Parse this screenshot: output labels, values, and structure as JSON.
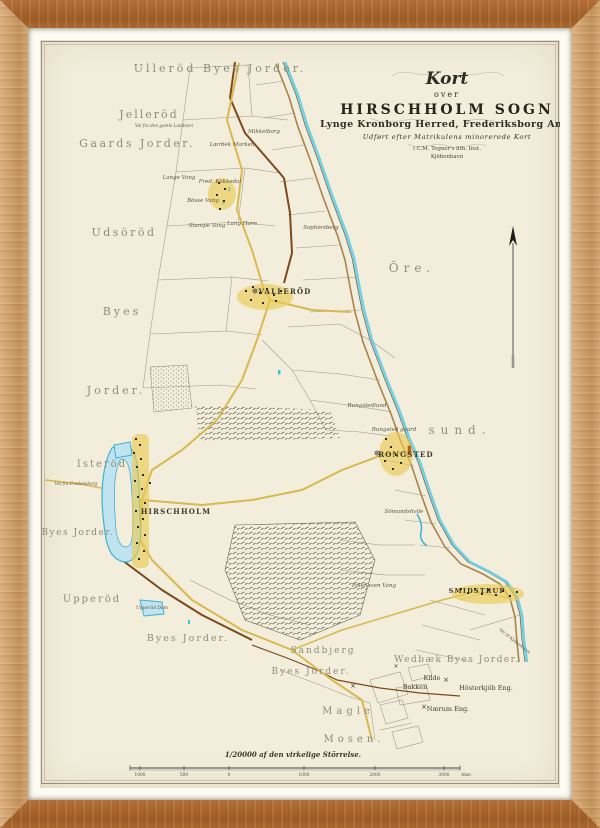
{
  "title_block": {
    "kort": "Kort",
    "over": "over",
    "main": "HIRSCHHOLM SOGN",
    "sub": "Lynge Kronborg Herred, Frederiksborg Amt.",
    "note": "Udført efter Matrikulens minorerede Kort",
    "publisher": "i C.M. Tegner's lith. Inst.",
    "city": "Kjöbenhavn"
  },
  "scale": {
    "caption": "1/20000 af den virkelige Störrelse."
  },
  "palette": {
    "paper": "#f3eedc",
    "mat": "#fdfbf2",
    "frame_wood": "#cb9c66",
    "coast_cyan": "#63cde2",
    "road_yellow": "#d9b84e",
    "road_tan": "#a8834b",
    "boundary_brown": "#7a4a1c",
    "lake_blue": "#3fb0d0",
    "village_yellow": "#e9cb53",
    "building_orange": "#cc6418",
    "label_grey": "#8f8c7c",
    "ink": "#3b372c"
  },
  "map_labels": [
    {
      "t": "Ulleröd Byes Jorder.",
      "x": 180,
      "y": 32,
      "fs": 11,
      "ls": 3,
      "style": "district"
    },
    {
      "t": "Jelleröd",
      "x": 109,
      "y": 78,
      "fs": 11,
      "ls": 2,
      "style": "district"
    },
    {
      "t": "Gaards Jorder.",
      "x": 97,
      "y": 107,
      "fs": 11,
      "ls": 2.5,
      "style": "district"
    },
    {
      "t": "Udsöröd",
      "x": 84,
      "y": 196,
      "fs": 11,
      "ls": 2.5,
      "style": "district"
    },
    {
      "t": "Byes",
      "x": 82,
      "y": 275,
      "fs": 11,
      "ls": 3,
      "style": "district"
    },
    {
      "t": "Jorder.",
      "x": 76,
      "y": 354,
      "fs": 11,
      "ls": 3,
      "style": "district"
    },
    {
      "t": "Isteröd",
      "x": 62,
      "y": 427,
      "fs": 10,
      "ls": 2,
      "style": "district"
    },
    {
      "t": "Byes Jorder.",
      "x": 38,
      "y": 495,
      "fs": 9,
      "ls": 1.5,
      "style": "district"
    },
    {
      "t": "Upperöd",
      "x": 52,
      "y": 562,
      "fs": 10,
      "ls": 2,
      "style": "district"
    },
    {
      "t": "Byes Jorder.",
      "x": 148,
      "y": 601,
      "fs": 9.5,
      "ls": 2,
      "style": "district"
    },
    {
      "t": "Sandbjerg",
      "x": 283,
      "y": 613,
      "fs": 9,
      "ls": 2,
      "style": "district"
    },
    {
      "t": "Byes Jorder.",
      "x": 271,
      "y": 634,
      "fs": 9,
      "ls": 2,
      "style": "district"
    },
    {
      "t": "Magle",
      "x": 308,
      "y": 674,
      "fs": 10,
      "ls": 4,
      "style": "district"
    },
    {
      "t": "Mosen.",
      "x": 314,
      "y": 702,
      "fs": 10,
      "ls": 4,
      "style": "district"
    },
    {
      "t": "Wedbæk Byes Jorder.",
      "x": 417,
      "y": 622,
      "fs": 9,
      "ls": 1.5,
      "style": "district"
    },
    {
      "t": "Öre.",
      "x": 372,
      "y": 232,
      "fs": 12,
      "ls": 5,
      "style": "sea"
    },
    {
      "t": "sund.",
      "x": 420,
      "y": 394,
      "fs": 12,
      "ls": 6,
      "style": "sea"
    },
    {
      "t": "VALLERÖD",
      "x": 245,
      "y": 254,
      "fs": 7,
      "ls": 1.2,
      "style": "town"
    },
    {
      "t": "HIRSCHHOLM",
      "x": 136,
      "y": 474,
      "fs": 7,
      "ls": 1.2,
      "style": "town"
    },
    {
      "t": "RONGSTED",
      "x": 366,
      "y": 417,
      "fs": 7,
      "ls": 1.2,
      "style": "town"
    },
    {
      "t": "SMIDSTRUP",
      "x": 437,
      "y": 553,
      "fs": 6.5,
      "ls": 1.2,
      "style": "town"
    },
    {
      "t": "Mikkelborg",
      "x": 224,
      "y": 93,
      "fs": 5.5,
      "style": "small"
    },
    {
      "t": "Lærbek Marken",
      "x": 192,
      "y": 106,
      "fs": 5.5,
      "style": "small"
    },
    {
      "t": "Lange Vang",
      "x": 139,
      "y": 139,
      "fs": 5.5,
      "style": "small"
    },
    {
      "t": "Fred. Kokkedal",
      "x": 180,
      "y": 143,
      "fs": 5.5,
      "style": "small"
    },
    {
      "t": "Bösse Vang",
      "x": 163,
      "y": 162,
      "fs": 5.5,
      "style": "small"
    },
    {
      "t": "Stampe Vang",
      "x": 167,
      "y": 187,
      "fs": 5.5,
      "style": "small"
    },
    {
      "t": "Lang Horn",
      "x": 202,
      "y": 185,
      "fs": 5.5,
      "style": "small"
    },
    {
      "t": "Sophienberg",
      "x": 281,
      "y": 189,
      "fs": 5.5,
      "style": "small"
    },
    {
      "t": "Rungstedlund",
      "x": 327,
      "y": 367,
      "fs": 5.5,
      "style": "small"
    },
    {
      "t": "Rungsted gaard",
      "x": 354,
      "y": 391,
      "fs": 5.5,
      "style": "small"
    },
    {
      "t": "Sömandshvile",
      "x": 364,
      "y": 473,
      "fs": 5.5,
      "style": "small"
    },
    {
      "t": "Folehaven Vang",
      "x": 334,
      "y": 547,
      "fs": 5.5,
      "style": "small"
    },
    {
      "t": "Upperöd Dam",
      "x": 112,
      "y": 569,
      "fs": 4.5,
      "style": "small"
    },
    {
      "t": "Vei fra den gamle Landevei",
      "x": 124,
      "y": 87,
      "fs": 4.2,
      "style": "small"
    },
    {
      "t": "Vei fra Fredensborg",
      "x": 36,
      "y": 445,
      "fs": 4.2,
      "style": "small"
    },
    {
      "t": "Vei til Kjöbenhavn",
      "x": 474,
      "y": 602,
      "fs": 4.2,
      "style": "small",
      "rot": 38
    },
    {
      "t": "Kilde",
      "x": 392,
      "y": 640,
      "fs": 6.5,
      "style": "eng"
    },
    {
      "t": "Bakken",
      "x": 375,
      "y": 649,
      "fs": 6.5,
      "style": "eng"
    },
    {
      "t": "Hösterkjöb Eng.",
      "x": 446,
      "y": 650,
      "fs": 6.5,
      "style": "eng"
    },
    {
      "t": "Nærum Eng.",
      "x": 408,
      "y": 671,
      "fs": 6.5,
      "style": "eng"
    },
    {
      "t": "×",
      "x": 406,
      "y": 642,
      "fs": 7,
      "style": "sym"
    },
    {
      "t": "×",
      "x": 384,
      "y": 669,
      "fs": 7,
      "style": "sym"
    },
    {
      "t": "×",
      "x": 313,
      "y": 648,
      "fs": 7,
      "style": "sym"
    },
    {
      "t": "×",
      "x": 356,
      "y": 628,
      "fs": 6,
      "style": "sym"
    },
    {
      "t": "1000",
      "x": 100,
      "y": 736,
      "fs": 4.3,
      "style": "tick"
    },
    {
      "t": "500",
      "x": 144,
      "y": 736,
      "fs": 4.3,
      "style": "tick"
    },
    {
      "t": "0",
      "x": 189,
      "y": 736,
      "fs": 4.3,
      "style": "tick"
    },
    {
      "t": "1000",
      "x": 264,
      "y": 736,
      "fs": 4.3,
      "style": "tick"
    },
    {
      "t": "2000",
      "x": 335,
      "y": 736,
      "fs": 4.3,
      "style": "tick"
    },
    {
      "t": "3000",
      "x": 404,
      "y": 736,
      "fs": 4.3,
      "style": "tick"
    },
    {
      "t": "Alen",
      "x": 426,
      "y": 736,
      "fs": 4.3,
      "style": "tick"
    }
  ]
}
